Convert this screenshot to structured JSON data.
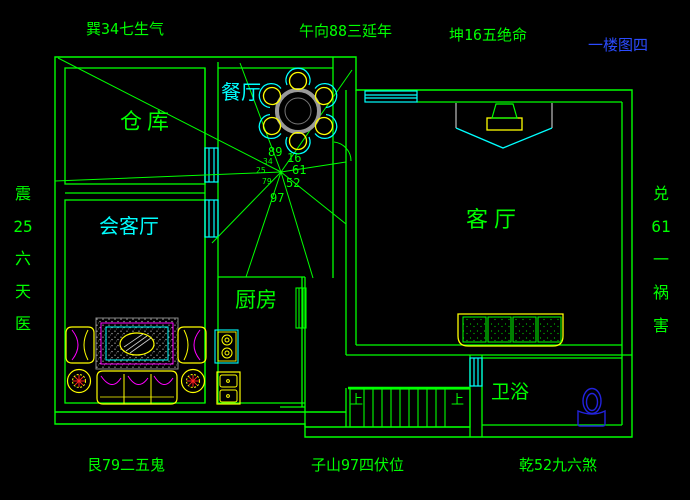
{
  "drawing_title": "一楼图四",
  "compass": {
    "top": [
      "巽34七生气",
      "午向88三延年",
      "坤16五绝命"
    ],
    "bottom": [
      "艮79二五鬼",
      "子山97四伏位",
      "乾52九六煞"
    ],
    "left": [
      "震",
      "25",
      "六",
      "天",
      "医"
    ],
    "right": [
      "兑",
      "61",
      "一",
      "祸",
      "害"
    ]
  },
  "rooms": {
    "storage": "仓库",
    "dining": "餐厅",
    "reception": "会客厅",
    "kitchen": "厨房",
    "living": "客厅",
    "bathroom": "卫浴"
  },
  "center_numbers": {
    "n_89": "89",
    "n_16": "16",
    "n_61": "61",
    "n_52": "52",
    "n_97": "97",
    "s_34": "34",
    "s_25": "25",
    "s_79": "79"
  },
  "stairs": {
    "up_label": "上"
  },
  "colors": {
    "background": "#000000",
    "wall_green": "#00ff00",
    "window_cyan": "#00ffff",
    "furniture_yellow": "#ffff00",
    "accent_magenta": "#ff00ff",
    "plant_red": "#ff2020",
    "toilet_blue": "#2222dd",
    "title_blue": "#2b4bff",
    "detail_gray": "#9a9a9a"
  }
}
